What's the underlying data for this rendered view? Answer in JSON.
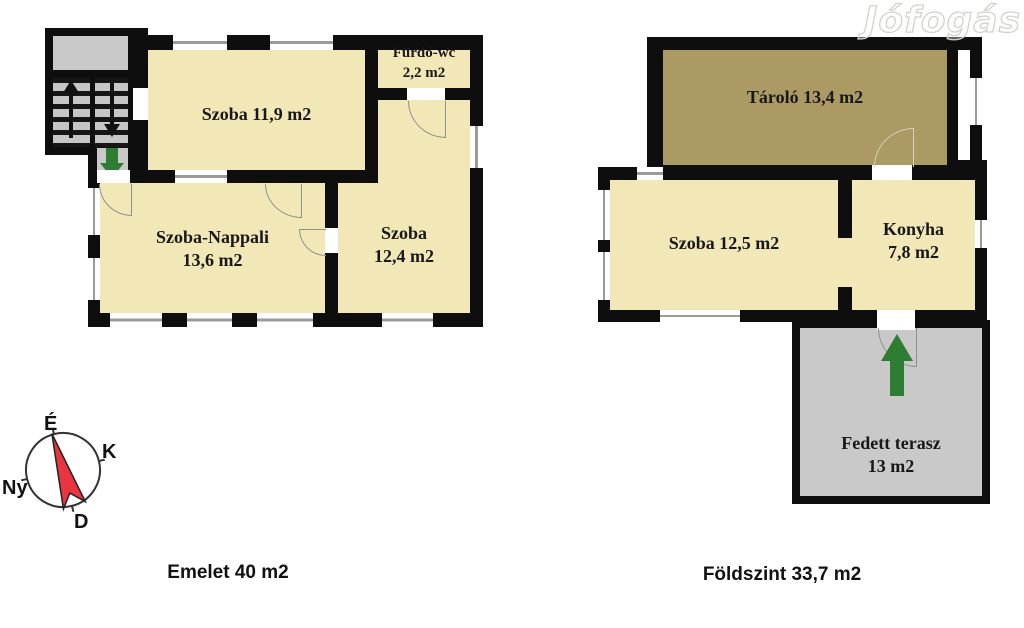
{
  "colors": {
    "wall": "#0e0e0e",
    "cream": "#f2e7b7",
    "tan": "#ab9a63",
    "gray": "#c9c9c9",
    "green": "#2e7d32",
    "red": "#e8353f",
    "arc_line": "#909090"
  },
  "watermark": {
    "text": "Jófogás"
  },
  "compass": {
    "north": "É",
    "east": "K",
    "south": "D",
    "west": "Ny"
  },
  "emelet": {
    "caption": "Emelet 40 m2",
    "rooms": {
      "szoba_felso": {
        "label": "Szoba 11,9 m2"
      },
      "furdo_wc": {
        "line1": "Fürdő-wc",
        "line2": "2,2 m2"
      },
      "szoba_nappali": {
        "line1": "Szoba-Nappali",
        "line2": "13,6 m2"
      },
      "szoba": {
        "line1": "Szoba",
        "line2": "12,4 m2"
      }
    }
  },
  "foldszint": {
    "caption": "Földszint 33,7 m2",
    "rooms": {
      "tarolo": {
        "label": "Tároló 13,4 m2"
      },
      "szoba": {
        "label": "Szoba 12,5 m2"
      },
      "konyha": {
        "line1": "Konyha",
        "line2": "7,8 m2"
      },
      "fedett_terasz": {
        "line1": "Fedett terasz",
        "line2": "13 m2"
      }
    }
  }
}
